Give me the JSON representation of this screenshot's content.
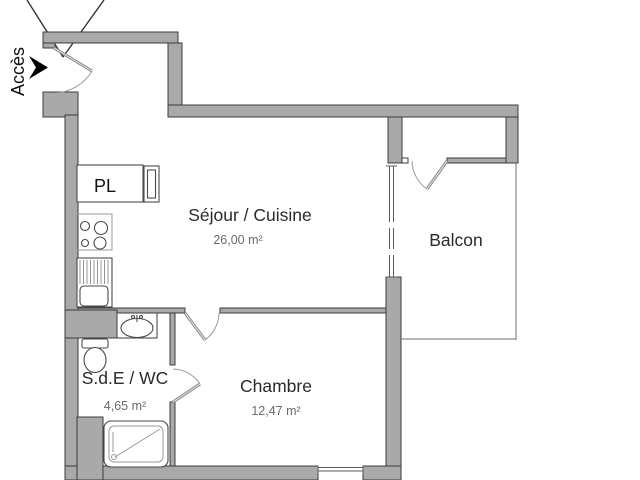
{
  "plan": {
    "access_label": "Accès",
    "closet_label": "PL",
    "rooms": {
      "living": {
        "name": "Séjour / Cuisine",
        "area": "26,00 m²"
      },
      "balcony": {
        "name": "Balcon"
      },
      "bedroom": {
        "name": "Chambre",
        "area": "12,47 m²"
      },
      "bathroom": {
        "name": "S.d.E / WC",
        "area": "4,65 m²"
      }
    },
    "colors": {
      "wall_fill": "#a9a9a9",
      "wall_edge": "#3c3c3c",
      "room_name_text": "#2a2a2a",
      "area_text": "#6a6a6a",
      "door_swing": "#9a9a9a",
      "access_arrow": "#000000"
    }
  }
}
